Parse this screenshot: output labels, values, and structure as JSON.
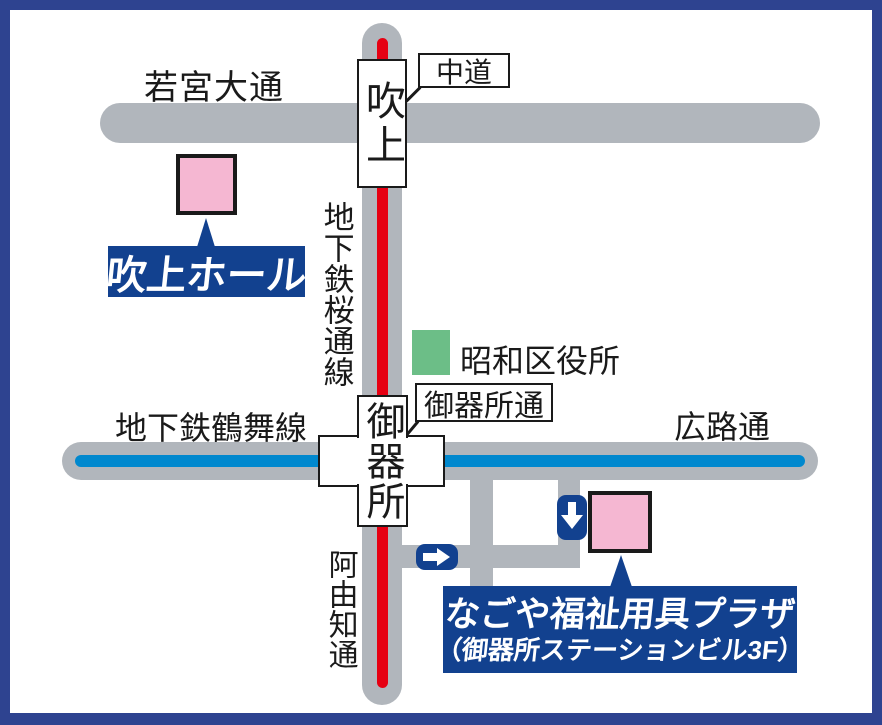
{
  "map_title": "access-map",
  "colors": {
    "frame_navy": "#2E4390",
    "label_navy": "#12418F",
    "road_gray": "#B1B6BC",
    "subway_red": "#E60012",
    "subway_blue": "#0088CE",
    "building_pink": "#F5B7D2",
    "building_green": "#6CBE87",
    "station_white": "#FFFFFF",
    "text_black": "#1A1A1A"
  },
  "roads": {
    "wakamiya_odori": "若宮大通",
    "nakamichi": "中道",
    "sakura_dori_line": "地下鉄桜通線",
    "tsurumai_line": "地下鉄鶴舞線",
    "hiroji_dori": "広路通",
    "gokiso_dori": "御器所通",
    "ayuchi_dori": "阿由知通"
  },
  "stations": {
    "fukiage": "吹上",
    "gokiso": "御器所"
  },
  "landmarks": {
    "fukiage_hall": "吹上ホール",
    "showa_ward_office": "昭和区役所",
    "plaza_name": "なごや福祉用具プラザ",
    "plaza_floor": "（御器所ステーションビル3F）"
  },
  "icons": {
    "down_arrow": "down-arrow-icon",
    "right_arrow": "right-arrow-icon"
  }
}
